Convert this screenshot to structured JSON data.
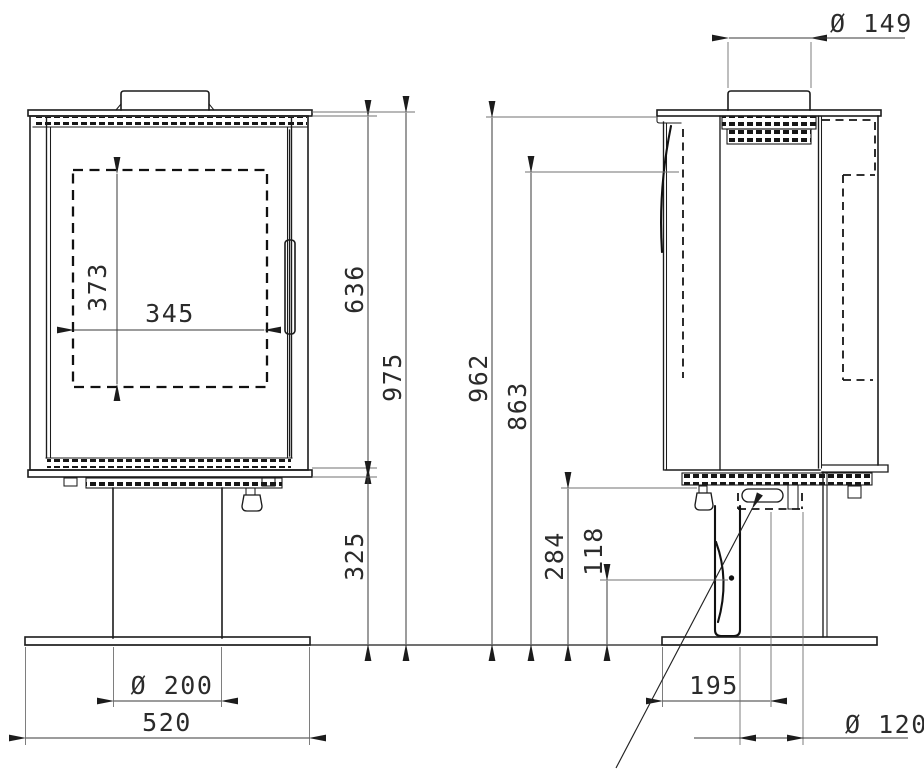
{
  "colors": {
    "background": "#ffffff",
    "line": "#1c1c1c",
    "dimension_line": "#3a3a3a",
    "text": "#2b2b2b"
  },
  "views": {
    "front": {
      "dimensions": {
        "glass_height": "373",
        "glass_width": "345",
        "body_height": "636",
        "overall_height": "975",
        "pedestal_height": "325",
        "pedestal_diameter": "Ø 200",
        "base_width": "520"
      }
    },
    "side": {
      "dimensions": {
        "flue_collar_diameter": "Ø 149",
        "overall_height": "962",
        "upper_edge_height": "863",
        "body_underside_height": "284",
        "control_pivot_height": "118",
        "front_to_column_center": "195",
        "column_depth": "Ø 120"
      }
    }
  }
}
